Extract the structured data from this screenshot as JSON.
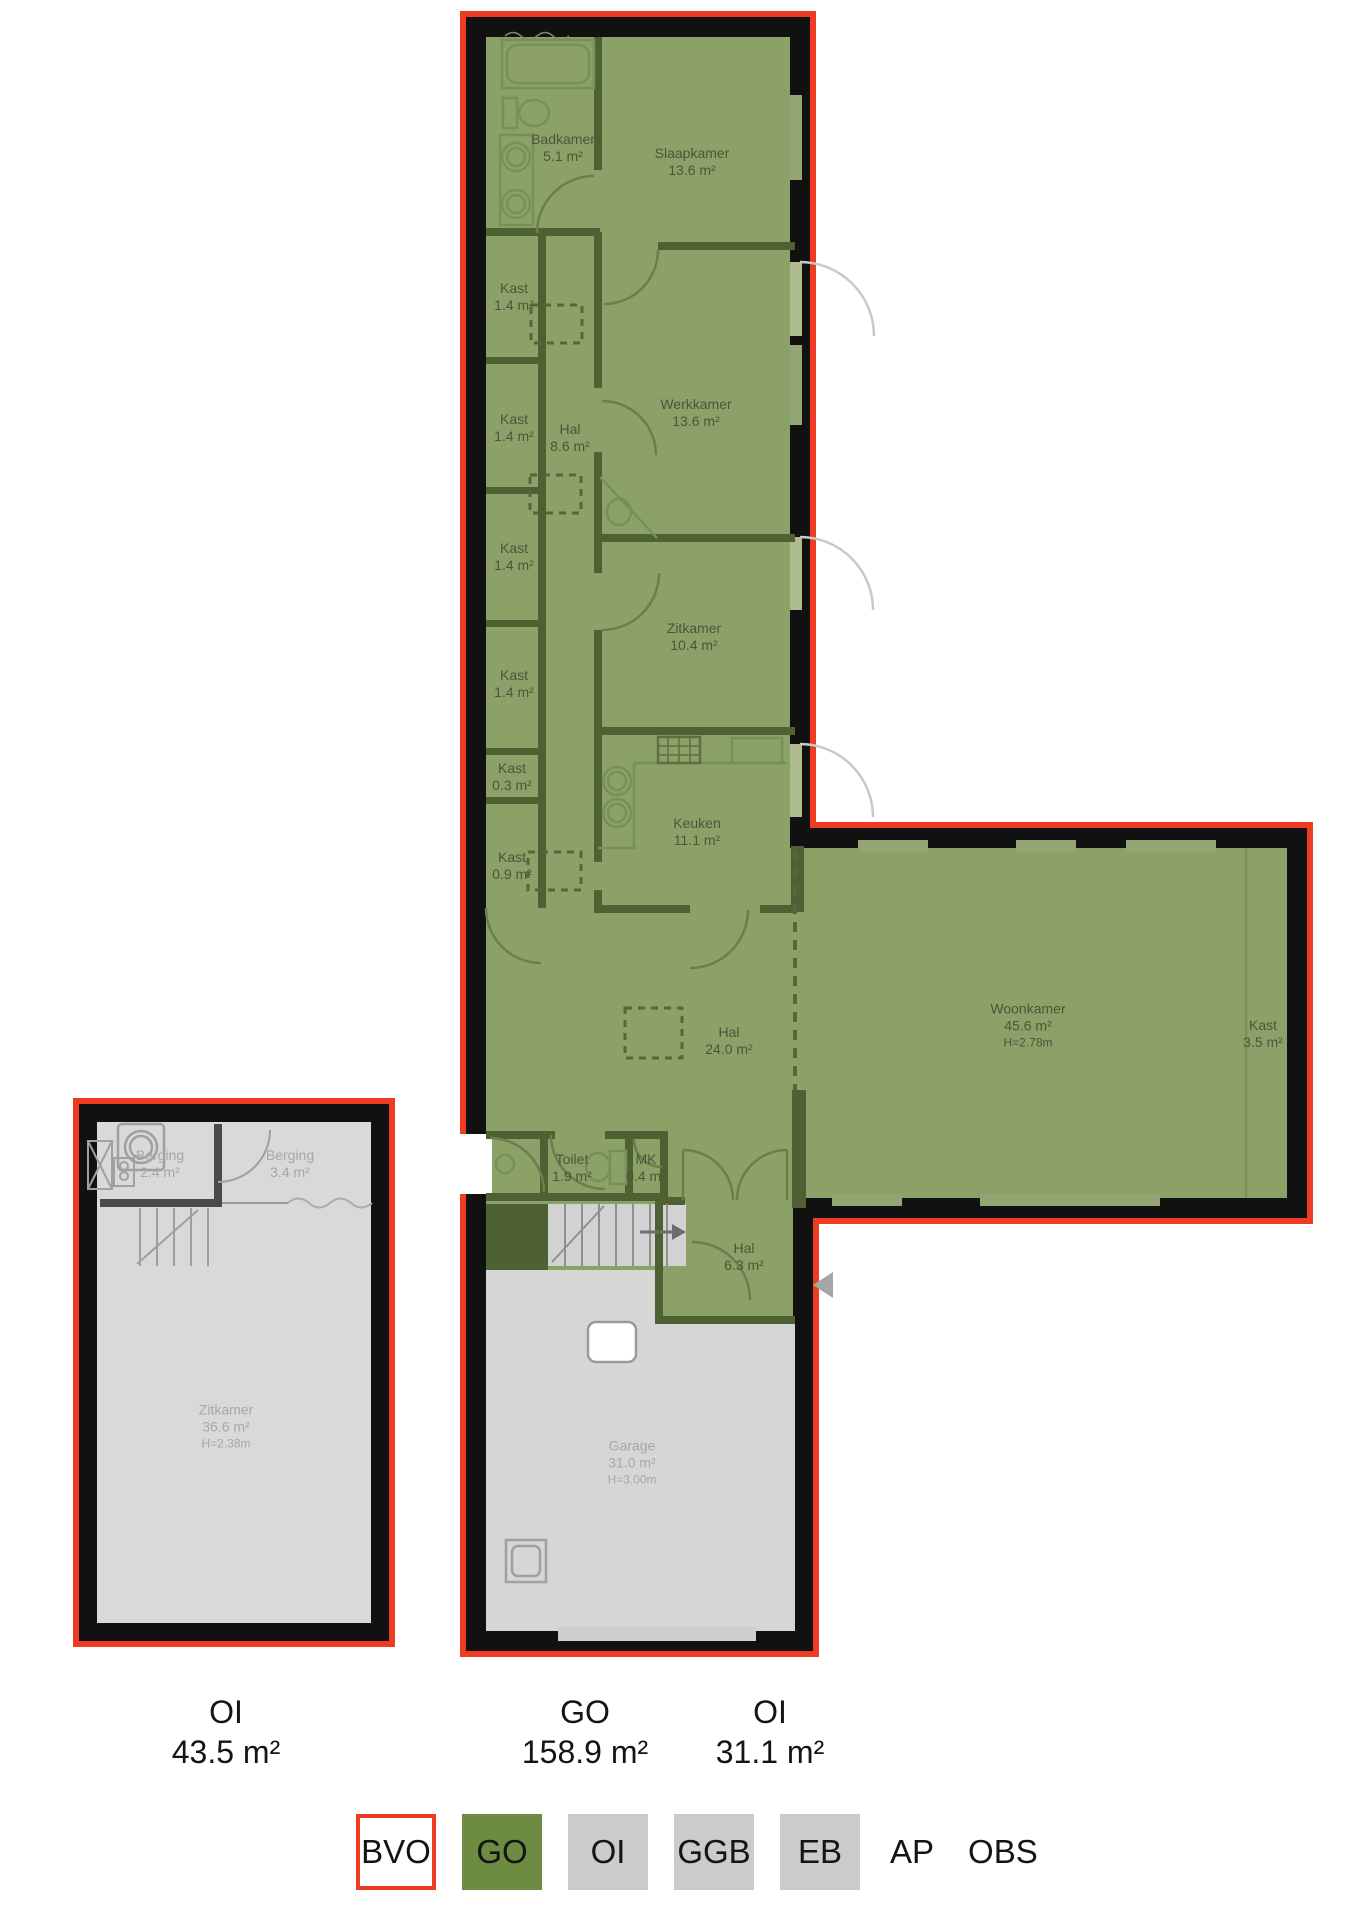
{
  "palette": {
    "outline_red": "#ee3c23",
    "wall_black": "#111111",
    "go_floor_green": "#8ca167",
    "go_wall_green": "#4d6133",
    "oi_floor_grey": "#d9d9d9",
    "garage_grey": "#d6d6d6",
    "legend_green": "#6d8b41",
    "legend_grey": "#cbcbcb",
    "label_green": "#4a5639",
    "label_grey": "#a7a7a7"
  },
  "rooms": {
    "badkamer": {
      "name": "Badkamer",
      "area": "5.1 m²"
    },
    "slaapkamer": {
      "name": "Slaapkamer",
      "area": "13.6 m²"
    },
    "kast1": {
      "name": "Kast",
      "area": "1.4 m²"
    },
    "kast2": {
      "name": "Kast",
      "area": "1.4 m²"
    },
    "kast3": {
      "name": "Kast",
      "area": "1.4 m²"
    },
    "kast4": {
      "name": "Kast",
      "area": "1.4 m²"
    },
    "hal_boven": {
      "name": "Hal",
      "area": "8.6 m²"
    },
    "werkkamer": {
      "name": "Werkkamer",
      "area": "13.6 m²"
    },
    "zitkamer": {
      "name": "Zitkamer",
      "area": "10.4 m²"
    },
    "kast5": {
      "name": "Kast",
      "area": "0.3 m²"
    },
    "kast6": {
      "name": "Kast",
      "area": "0.9 m²"
    },
    "keuken": {
      "name": "Keuken",
      "area": "11.1 m²"
    },
    "hal_midden": {
      "name": "Hal",
      "area": "24.0 m²"
    },
    "woonkamer": {
      "name": "Woonkamer",
      "area": "45.6 m²",
      "height": "H=2.78m"
    },
    "kast7": {
      "name": "Kast",
      "area": "3.5 m²"
    },
    "toilet": {
      "name": "Toilet",
      "area": "1.9 m²"
    },
    "mk": {
      "name": "MK",
      "area": "0.4 m²"
    },
    "hal_entree": {
      "name": "Hal",
      "area": "6.3 m²"
    },
    "garage": {
      "name": "Garage",
      "area": "31.0 m²",
      "height": "H=3.00m"
    }
  },
  "annex_rooms": {
    "berging1": {
      "name": "Berging",
      "area": "2.4 m²"
    },
    "berging2": {
      "name": "Berging",
      "area": "3.4 m²"
    },
    "zitkamer": {
      "name": "Zitkamer",
      "area": "36.6 m²",
      "height": "H=2.38m"
    }
  },
  "totals": {
    "oi_left": {
      "label": "OI",
      "value": "43.5 m²"
    },
    "go": {
      "label": "GO",
      "value": "158.9 m²"
    },
    "oi_right": {
      "label": "OI",
      "value": "31.1 m²"
    }
  },
  "legend": {
    "bvo": "BVO",
    "go": "GO",
    "oi": "OI",
    "ggb": "GGB",
    "eb": "EB",
    "ap": "AP",
    "obs": "OBS"
  }
}
